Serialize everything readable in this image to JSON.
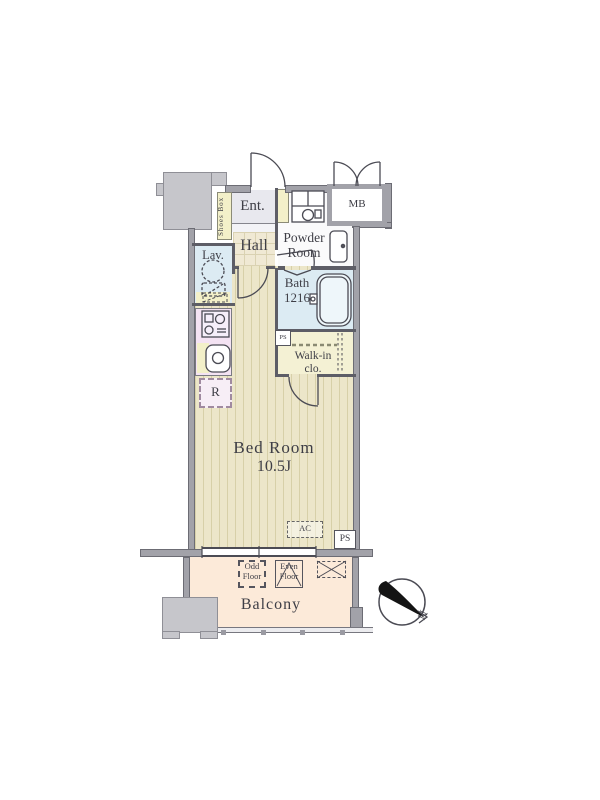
{
  "colors": {
    "wall": "#a2a2a9",
    "wallEdge": "#6c6c74",
    "wallDark": "#5d5d66",
    "structure": "#c6c6cb",
    "structureEdge": "#8f8f96",
    "flooring": "#ece6c9",
    "stripe": "#d7d0a8",
    "hallTile": "#f0e9d4",
    "tileLine": "#dad2b2",
    "entrance": "#e8e8ee",
    "step": "#f3f3f7",
    "powder": "#fafafb",
    "water": "#dcebf3",
    "tub": "#eef6fa",
    "kitchen": "#f4e3f3",
    "yellow": "#f3f0c9",
    "walkin": "#f4f1d4",
    "balcony": "#fcead9",
    "rbox": "#f7eef6",
    "text": "#3e3e46",
    "line": "#4b4b54"
  },
  "rooms": {
    "entrance": {
      "label": "Ent."
    },
    "shoes_box": {
      "label": "Shoes Box"
    },
    "meter_box": {
      "label": "MB"
    },
    "hall": {
      "label": "Hall"
    },
    "powder_room": {
      "line1": "Powder",
      "line2": "Room"
    },
    "lavatory": {
      "label": "Lav."
    },
    "bath": {
      "label": "Bath",
      "size": "1216"
    },
    "walk_in_closet": {
      "line1": "Walk-in",
      "line2": "clo."
    },
    "bedroom": {
      "label": "Bed Room",
      "size": "10.5J"
    },
    "balcony": {
      "label": "Balcony"
    },
    "refrigerator": {
      "label": "R"
    }
  },
  "markers": {
    "ps_upper": "PS",
    "ps_lower": "PS",
    "ac": "AC",
    "odd_floor": {
      "line1": "Odd",
      "line2": "Floor"
    },
    "even_floor": {
      "line1": "Even",
      "line2": "Floor"
    },
    "north": "N"
  }
}
